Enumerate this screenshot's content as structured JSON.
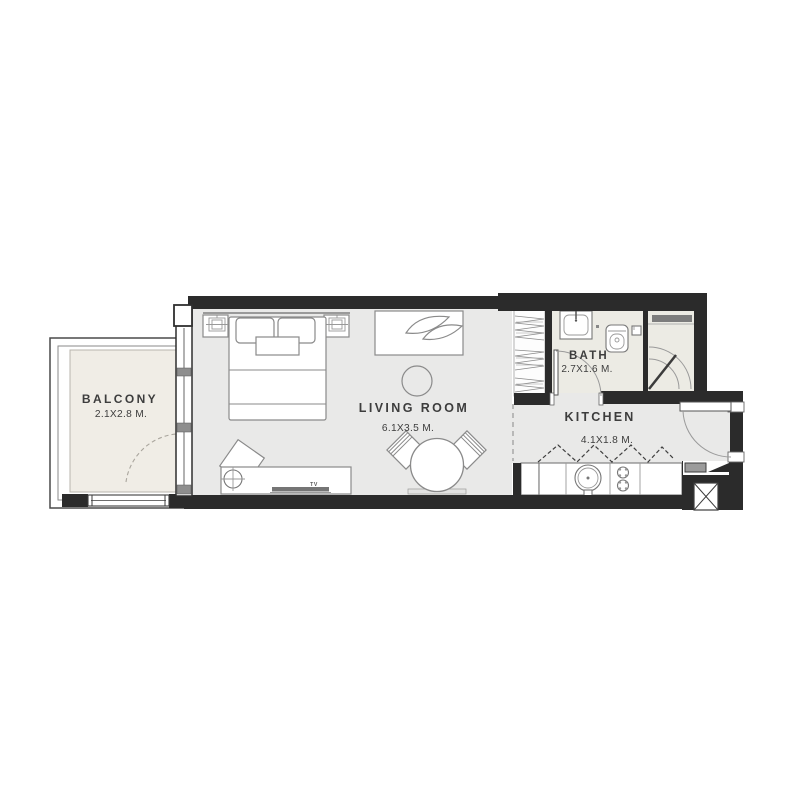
{
  "floor_plan": {
    "rooms": [
      {
        "id": "balcony",
        "name": "BALCONY",
        "dimensions": "2.1X2.8 M."
      },
      {
        "id": "living-room",
        "name": "LIVING ROOM",
        "dimensions": "6.1X3.5 M."
      },
      {
        "id": "bath",
        "name": "BATH",
        "dimensions": "2.7X1.6 M."
      },
      {
        "id": "kitchen",
        "name": "KITCHEN",
        "dimensions": "4.1X1.8 M."
      }
    ],
    "furniture_labels": {
      "tv": "TV"
    },
    "colors": {
      "wall": "#2b2b2b",
      "floor_main": "#e9e9e8",
      "floor_balcony": "#f0ede6",
      "floor_bath": "#ecebe4",
      "furniture_stroke": "#8a8a8a",
      "fixture_stroke": "#777777",
      "text": "#3d3d3d",
      "background": "#ffffff"
    }
  }
}
